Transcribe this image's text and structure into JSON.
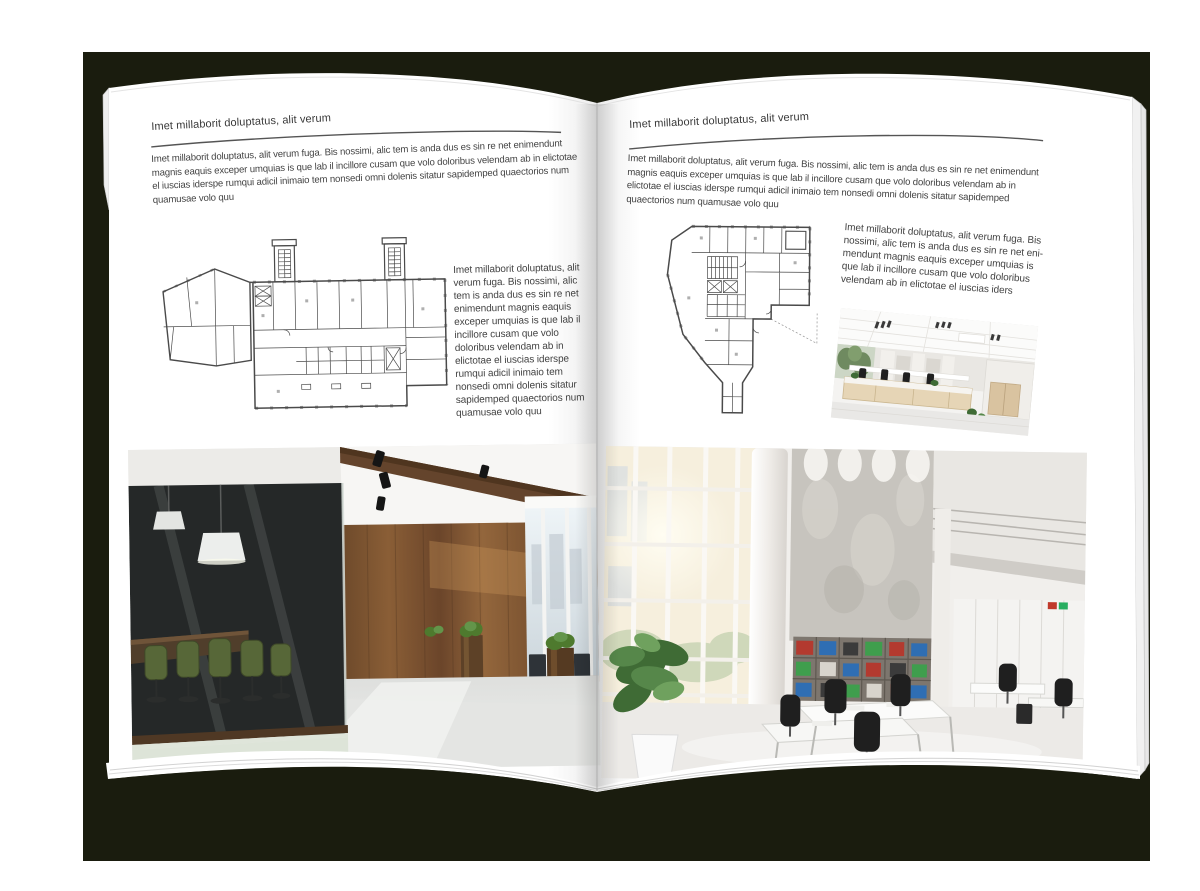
{
  "colors": {
    "backdrop": "#1a1c0e",
    "page": "#ffffff",
    "text": "#434343",
    "rule": "#555555",
    "plan_lines": "#4a4a4a",
    "wood": "#7a5230",
    "chair_green": "#51602f"
  },
  "left_page": {
    "header": "Imet millaborit doluptatus, alit verum",
    "intro": "Imet millaborit doluptatus, alit verum fuga. Bis nossimi, alic tem is anda dus es sin re net enimendunt magnis eaquis exceper umquias is que lab il incillore cusam que volo doloribus velendam ab in elictotae el iuscias iderspe rumqui adicil inimaio tem nonsedi omni dolenis sitatur sapidemped quaectorios num quamusae volo quu",
    "side_text": "Imet millaborit doluptatus, alit verum fuga. Bis nossimi, alic tem is anda dus es sin re net enimendunt magnis eaquis exceper umquias is que lab il incillore cusam que volo doloribus velendam ab in elictotae el iuscias iderspe rumqui adicil inimaio tem nonsedi omni dolenis sitatur sapidemped quaectorios num quamusae volo quu"
  },
  "right_page": {
    "header": "Imet millaborit doluptatus, alit verum",
    "intro": "Imet millaborit doluptatus, alit verum fuga. Bis nossimi, alic tem is anda dus es sin re net enimendunt magnis eaquis exceper umquias is que lab il incillore cusam que volo doloribus velendam ab in elictotae el iuscias iderspe rumqui adicil inimaio tem nonsedi omni dolenis sitatur sapidemped quaectorios num quamusae volo quu",
    "side_text": "Imet millaborit doluptatus, alit verum fuga. Bis nossimi, alic tem is anda dus es sin re net eni-mendunt magnis eaquis exceper umquias is que lab il incillore cusam que volo doloribus velendam ab in elictotae el iuscias iders"
  }
}
